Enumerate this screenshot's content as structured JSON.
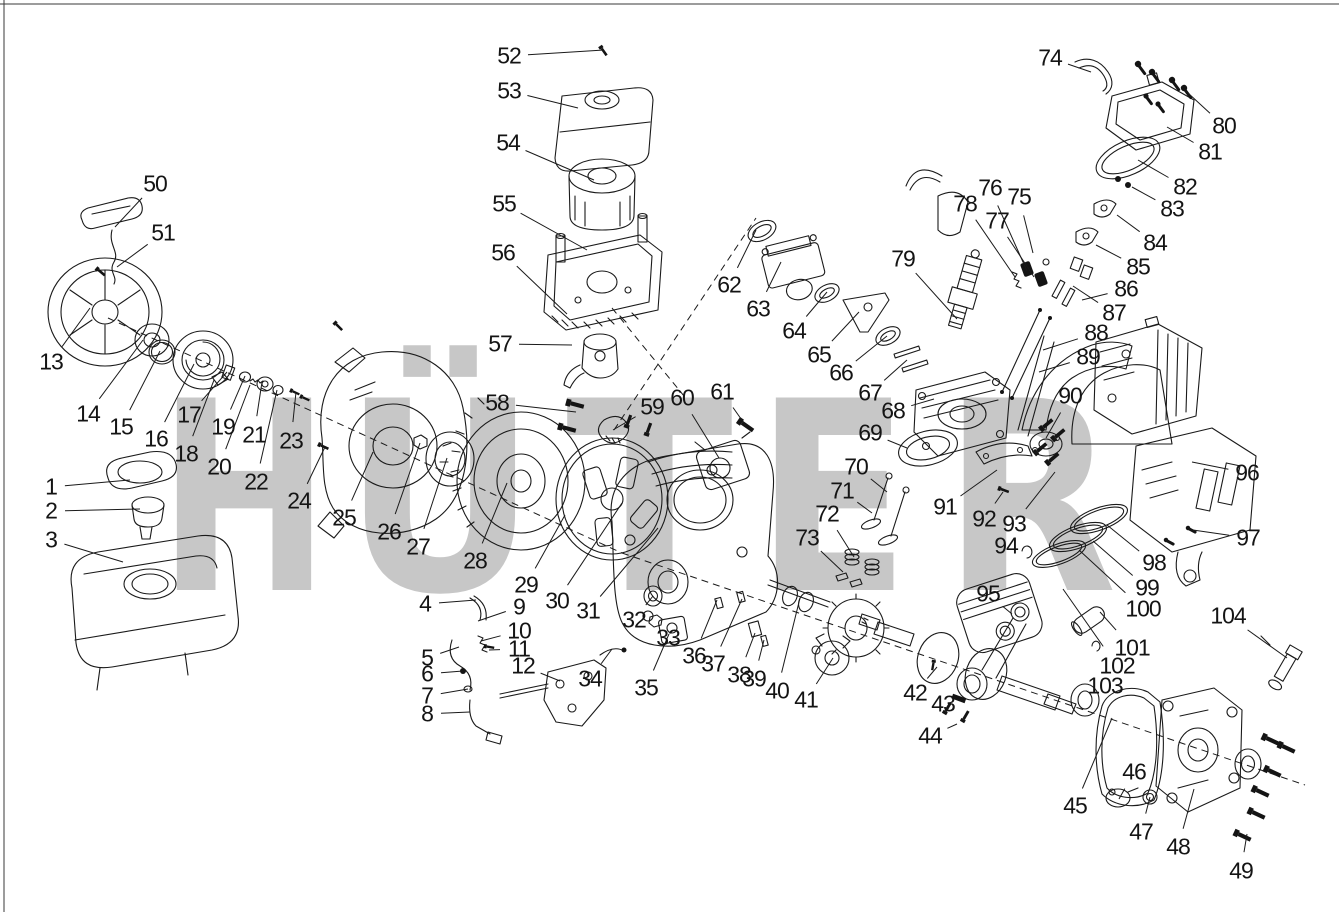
{
  "page": {
    "background": "#ffffff",
    "border_color": "#2f2f2f"
  },
  "watermark": {
    "text": "HÜTER",
    "color": "#c7c7c7",
    "baseline_y": 590,
    "font_px": 264,
    "letters": [
      {
        "ch": "H",
        "x": 158,
        "w": 172
      },
      {
        "ch": "Ü",
        "x": 343,
        "w": 194
      },
      {
        "ch": "T",
        "x": 566,
        "w": 167
      },
      {
        "ch": "E",
        "x": 755,
        "w": 155
      },
      {
        "ch": "R",
        "x": 943,
        "w": 174
      }
    ],
    "logo_arc_red": "#f2adb5",
    "logo_arc_yellow": "#f9f5c0"
  },
  "diagram": {
    "type": "exploded-parts-diagram",
    "labels": [
      {
        "n": "1",
        "x": 51,
        "y": 487,
        "tx": 130,
        "ty": 480
      },
      {
        "n": "2",
        "x": 51,
        "y": 511,
        "tx": 140,
        "ty": 509
      },
      {
        "n": "3",
        "x": 51,
        "y": 540,
        "tx": 123,
        "ty": 562
      },
      {
        "n": "4",
        "x": 425,
        "y": 604,
        "tx": 476,
        "ty": 600
      },
      {
        "n": "5",
        "x": 427,
        "y": 658,
        "tx": 459,
        "ty": 647
      },
      {
        "n": "6",
        "x": 427,
        "y": 674,
        "tx": 463,
        "ty": 671
      },
      {
        "n": "7",
        "x": 427,
        "y": 696,
        "tx": 468,
        "ty": 689
      },
      {
        "n": "8",
        "x": 427,
        "y": 714,
        "tx": 470,
        "ty": 712
      },
      {
        "n": "9",
        "x": 519,
        "y": 607,
        "tx": 478,
        "ty": 621
      },
      {
        "n": "10",
        "x": 519,
        "y": 631,
        "tx": 481,
        "ty": 641
      },
      {
        "n": "11",
        "x": 519,
        "y": 649,
        "tx": 489,
        "ty": 650
      },
      {
        "n": "12",
        "x": 523,
        "y": 666,
        "tx": 560,
        "ty": 681
      },
      {
        "n": "13",
        "x": 51,
        "y": 362,
        "tx": 90,
        "ty": 308
      },
      {
        "n": "14",
        "x": 88,
        "y": 414,
        "tx": 143,
        "ty": 340
      },
      {
        "n": "15",
        "x": 121,
        "y": 427,
        "tx": 160,
        "ty": 351
      },
      {
        "n": "16",
        "x": 156,
        "y": 439,
        "tx": 194,
        "ty": 364
      },
      {
        "n": "17",
        "x": 189,
        "y": 415,
        "tx": 227,
        "ty": 372
      },
      {
        "n": "18",
        "x": 186,
        "y": 454,
        "tx": 214,
        "ty": 380
      },
      {
        "n": "19",
        "x": 223,
        "y": 427,
        "tx": 245,
        "ty": 376
      },
      {
        "n": "20",
        "x": 219,
        "y": 467,
        "tx": 250,
        "ty": 385
      },
      {
        "n": "21",
        "x": 254,
        "y": 435,
        "tx": 262,
        "ty": 382
      },
      {
        "n": "22",
        "x": 256,
        "y": 482,
        "tx": 277,
        "ty": 390
      },
      {
        "n": "23",
        "x": 291,
        "y": 441,
        "tx": 296,
        "ty": 392
      },
      {
        "n": "24",
        "x": 299,
        "y": 501,
        "tx": 325,
        "ty": 447
      },
      {
        "n": "25",
        "x": 344,
        "y": 518,
        "tx": 373,
        "ty": 452
      },
      {
        "n": "26",
        "x": 389,
        "y": 532,
        "tx": 420,
        "ty": 443
      },
      {
        "n": "27",
        "x": 418,
        "y": 547,
        "tx": 447,
        "ty": 458
      },
      {
        "n": "28",
        "x": 475,
        "y": 561,
        "tx": 507,
        "ty": 483
      },
      {
        "n": "29",
        "x": 526,
        "y": 585,
        "tx": 565,
        "ty": 515
      },
      {
        "n": "30",
        "x": 557,
        "y": 601,
        "tx": 622,
        "ty": 503
      },
      {
        "n": "31",
        "x": 588,
        "y": 611,
        "tx": 658,
        "ty": 528
      },
      {
        "n": "32",
        "x": 634,
        "y": 620,
        "tx": 653,
        "ty": 596
      },
      {
        "n": "33",
        "x": 668,
        "y": 638,
        "tx": 656,
        "ty": 621
      },
      {
        "n": "34",
        "x": 590,
        "y": 679,
        "tx": 612,
        "ty": 649
      },
      {
        "n": "35",
        "x": 646,
        "y": 688,
        "tx": 669,
        "ty": 634
      },
      {
        "n": "36",
        "x": 694,
        "y": 656,
        "tx": 717,
        "ty": 600
      },
      {
        "n": "37",
        "x": 713,
        "y": 664,
        "tx": 742,
        "ty": 599
      },
      {
        "n": "38",
        "x": 739,
        "y": 675,
        "tx": 755,
        "ty": 633
      },
      {
        "n": "39",
        "x": 754,
        "y": 679,
        "tx": 764,
        "ty": 640
      },
      {
        "n": "40",
        "x": 777,
        "y": 691,
        "tx": 800,
        "ty": 598
      },
      {
        "n": "41",
        "x": 806,
        "y": 700,
        "tx": 833,
        "ty": 658
      },
      {
        "n": "42",
        "x": 915,
        "y": 693,
        "tx": 937,
        "ty": 667
      },
      {
        "n": "43",
        "x": 943,
        "y": 704,
        "tx": 962,
        "ty": 699
      },
      {
        "n": "44",
        "x": 930,
        "y": 736,
        "tx": 957,
        "ty": 724
      },
      {
        "n": "45",
        "x": 1075,
        "y": 806,
        "tx": 1112,
        "ty": 718
      },
      {
        "n": "46",
        "x": 1134,
        "y": 772,
        "tx": 1119,
        "ty": 799
      },
      {
        "n": "47",
        "x": 1141,
        "y": 832,
        "tx": 1150,
        "ty": 797
      },
      {
        "n": "48",
        "x": 1178,
        "y": 847,
        "tx": 1194,
        "ty": 789
      },
      {
        "n": "49",
        "x": 1241,
        "y": 871,
        "tx": 1247,
        "ty": 834
      },
      {
        "n": "50",
        "x": 155,
        "y": 184,
        "tx": 115,
        "ty": 227
      },
      {
        "n": "51",
        "x": 163,
        "y": 233,
        "tx": 117,
        "ty": 267
      },
      {
        "n": "52",
        "x": 509,
        "y": 56,
        "tx": 604,
        "ty": 50
      },
      {
        "n": "53",
        "x": 509,
        "y": 91,
        "tx": 578,
        "ty": 108
      },
      {
        "n": "54",
        "x": 508,
        "y": 143,
        "tx": 594,
        "ty": 180
      },
      {
        "n": "55",
        "x": 504,
        "y": 204,
        "tx": 587,
        "ty": 250
      },
      {
        "n": "56",
        "x": 503,
        "y": 253,
        "tx": 567,
        "ty": 314
      },
      {
        "n": "57",
        "x": 500,
        "y": 344,
        "tx": 572,
        "ty": 345
      },
      {
        "n": "58",
        "x": 497,
        "y": 403,
        "tx": 576,
        "ty": 412
      },
      {
        "n": "59",
        "x": 652,
        "y": 407,
        "tx": 613,
        "ty": 430
      },
      {
        "n": "60",
        "x": 682,
        "y": 398,
        "tx": 719,
        "ty": 458
      },
      {
        "n": "61",
        "x": 722,
        "y": 392,
        "tx": 746,
        "ty": 426
      },
      {
        "n": "62",
        "x": 729,
        "y": 285,
        "tx": 756,
        "ty": 230
      },
      {
        "n": "63",
        "x": 758,
        "y": 309,
        "tx": 781,
        "ty": 262
      },
      {
        "n": "64",
        "x": 794,
        "y": 331,
        "tx": 827,
        "ty": 292
      },
      {
        "n": "65",
        "x": 819,
        "y": 355,
        "tx": 859,
        "ty": 312
      },
      {
        "n": "66",
        "x": 841,
        "y": 373,
        "tx": 887,
        "ty": 336
      },
      {
        "n": "67",
        "x": 870,
        "y": 393,
        "tx": 907,
        "ty": 360
      },
      {
        "n": "68",
        "x": 893,
        "y": 411,
        "tx": 934,
        "ty": 399
      },
      {
        "n": "69",
        "x": 870,
        "y": 433,
        "tx": 907,
        "ty": 448
      },
      {
        "n": "70",
        "x": 856,
        "y": 467,
        "tx": 887,
        "ty": 492
      },
      {
        "n": "71",
        "x": 842,
        "y": 491,
        "tx": 872,
        "ty": 513
      },
      {
        "n": "72",
        "x": 827,
        "y": 514,
        "tx": 854,
        "ty": 557
      },
      {
        "n": "73",
        "x": 807,
        "y": 538,
        "tx": 843,
        "ty": 572
      },
      {
        "n": "74",
        "x": 1050,
        "y": 58,
        "tx": 1091,
        "ty": 72
      },
      {
        "n": "75",
        "x": 1019,
        "y": 197,
        "tx": 1033,
        "ty": 253
      },
      {
        "n": "76",
        "x": 990,
        "y": 188,
        "tx": 1027,
        "ty": 271
      },
      {
        "n": "77",
        "x": 997,
        "y": 221,
        "tx": 1034,
        "ty": 277
      },
      {
        "n": "78",
        "x": 965,
        "y": 204,
        "tx": 1015,
        "ty": 277
      },
      {
        "n": "79",
        "x": 903,
        "y": 259,
        "tx": 957,
        "ty": 319
      },
      {
        "n": "80",
        "x": 1224,
        "y": 126,
        "tx": 1188,
        "ty": 93
      },
      {
        "n": "81",
        "x": 1210,
        "y": 152,
        "tx": 1167,
        "ty": 127
      },
      {
        "n": "82",
        "x": 1185,
        "y": 187,
        "tx": 1138,
        "ty": 160
      },
      {
        "n": "83",
        "x": 1172,
        "y": 209,
        "tx": 1132,
        "ty": 187
      },
      {
        "n": "84",
        "x": 1155,
        "y": 243,
        "tx": 1117,
        "ty": 215
      },
      {
        "n": "85",
        "x": 1138,
        "y": 267,
        "tx": 1096,
        "ty": 245
      },
      {
        "n": "86",
        "x": 1126,
        "y": 289,
        "tx": 1082,
        "ty": 300
      },
      {
        "n": "87",
        "x": 1114,
        "y": 313,
        "tx": 1073,
        "ty": 286
      },
      {
        "n": "88",
        "x": 1096,
        "y": 333,
        "tx": 1043,
        "ty": 350
      },
      {
        "n": "89",
        "x": 1088,
        "y": 357,
        "tx": 1039,
        "ty": 372
      },
      {
        "n": "90",
        "x": 1070,
        "y": 396,
        "tx": 1046,
        "ty": 438
      },
      {
        "n": "91",
        "x": 945,
        "y": 507,
        "tx": 997,
        "ty": 470
      },
      {
        "n": "92",
        "x": 984,
        "y": 519,
        "tx": 1003,
        "ty": 492
      },
      {
        "n": "93",
        "x": 1014,
        "y": 524,
        "tx": 1055,
        "ty": 472
      },
      {
        "n": "94",
        "x": 1006,
        "y": 546,
        "tx": 1024,
        "ty": 553
      },
      {
        "n": "95",
        "x": 988,
        "y": 594,
        "tx": 1012,
        "ty": 614
      },
      {
        "n": "96",
        "x": 1247,
        "y": 473,
        "tx": 1192,
        "ty": 462
      },
      {
        "n": "97",
        "x": 1248,
        "y": 538,
        "tx": 1193,
        "ty": 530
      },
      {
        "n": "98",
        "x": 1154,
        "y": 563,
        "tx": 1107,
        "ty": 525
      },
      {
        "n": "99",
        "x": 1147,
        "y": 588,
        "tx": 1093,
        "ty": 541
      },
      {
        "n": "100",
        "x": 1143,
        "y": 609,
        "tx": 1079,
        "ty": 550
      },
      {
        "n": "101",
        "x": 1132,
        "y": 648,
        "tx": 1100,
        "ty": 612
      },
      {
        "n": "102",
        "x": 1117,
        "y": 666,
        "tx": 1063,
        "ty": 589
      },
      {
        "n": "103",
        "x": 1105,
        "y": 686,
        "tx": 1085,
        "ty": 698
      },
      {
        "n": "104",
        "x": 1228,
        "y": 616,
        "tx": 1287,
        "ty": 658
      }
    ],
    "dashed_lines": [
      [
        614,
        430,
        756,
        218
      ],
      [
        612,
        308,
        684,
        396
      ],
      [
        108,
        318,
        622,
        553
      ],
      [
        622,
        553,
        1305,
        785
      ]
    ]
  }
}
